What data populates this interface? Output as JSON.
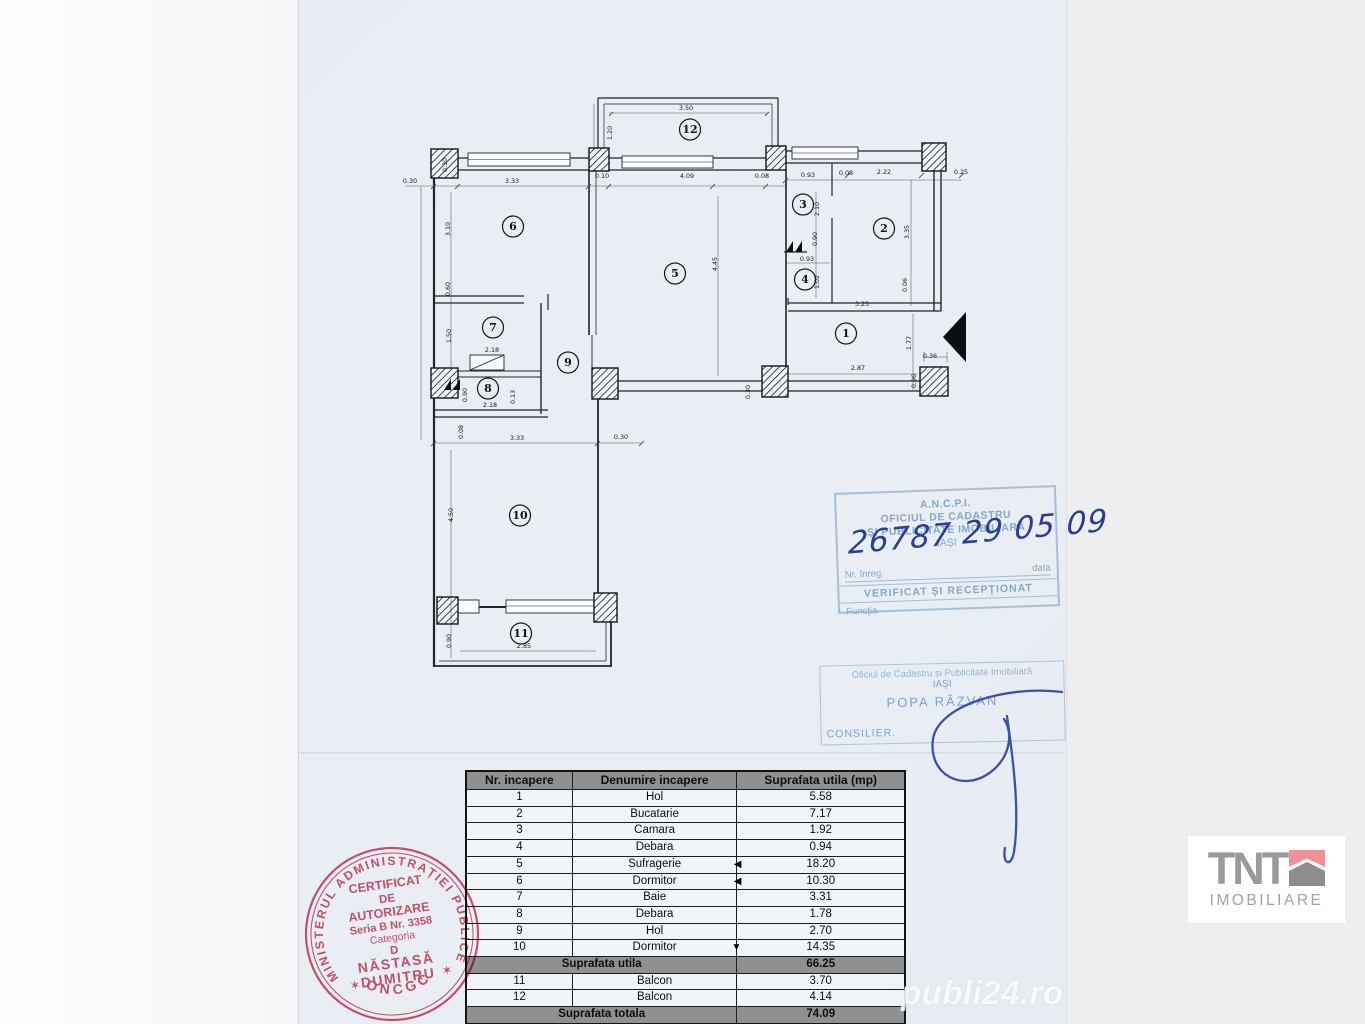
{
  "watermark": "publi24.ro",
  "logo": {
    "title": "TNT",
    "subtitle": "IMOBILIARE",
    "accent_pink": "#ef9097",
    "gray": "#9a9a9a"
  },
  "floorplan": {
    "rooms": [
      {
        "n": "1",
        "x": 846,
        "y": 337
      },
      {
        "n": "2",
        "x": 884,
        "y": 232
      },
      {
        "n": "3",
        "x": 803,
        "y": 208
      },
      {
        "n": "4",
        "x": 805,
        "y": 283
      },
      {
        "n": "5",
        "x": 675,
        "y": 277
      },
      {
        "n": "6",
        "x": 513,
        "y": 230
      },
      {
        "n": "7",
        "x": 493,
        "y": 331
      },
      {
        "n": "8",
        "x": 488,
        "y": 392
      },
      {
        "n": "9",
        "x": 568,
        "y": 366
      },
      {
        "n": "10",
        "x": 520,
        "y": 519
      },
      {
        "n": "11",
        "x": 521,
        "y": 637
      },
      {
        "n": "12",
        "x": 690,
        "y": 133
      }
    ],
    "dims": [
      {
        "t": "3.50",
        "x": 686,
        "y": 110,
        "r": 0
      },
      {
        "t": "1.20",
        "x": 612,
        "y": 133,
        "r": 1
      },
      {
        "t": "0.30",
        "x": 447,
        "y": 165,
        "r": 1
      },
      {
        "t": "0.30",
        "x": 410,
        "y": 183,
        "r": 0
      },
      {
        "t": "3.33",
        "x": 512,
        "y": 183,
        "r": 0
      },
      {
        "t": "0.10",
        "x": 602,
        "y": 178,
        "r": 0
      },
      {
        "t": "4.09",
        "x": 687,
        "y": 178,
        "r": 0
      },
      {
        "t": "0.08",
        "x": 762,
        "y": 178,
        "r": 0
      },
      {
        "t": "0.93",
        "x": 808,
        "y": 177,
        "r": 0
      },
      {
        "t": "0.08",
        "x": 846,
        "y": 175,
        "r": 0
      },
      {
        "t": "2.22",
        "x": 884,
        "y": 174,
        "r": 0
      },
      {
        "t": "0.25",
        "x": 961,
        "y": 174,
        "r": 0
      },
      {
        "t": "3.10",
        "x": 450,
        "y": 229,
        "r": 1
      },
      {
        "t": "0.60",
        "x": 450,
        "y": 289,
        "r": 1
      },
      {
        "t": "2.10",
        "x": 819,
        "y": 209,
        "r": 1
      },
      {
        "t": "0.90",
        "x": 817,
        "y": 239,
        "r": 1
      },
      {
        "t": "0.93",
        "x": 807,
        "y": 261,
        "r": 0
      },
      {
        "t": "1.02",
        "x": 819,
        "y": 282,
        "r": 1
      },
      {
        "t": "3.35",
        "x": 909,
        "y": 232,
        "r": 1
      },
      {
        "t": "0.06",
        "x": 907,
        "y": 285,
        "r": 1
      },
      {
        "t": "3.23",
        "x": 862,
        "y": 306,
        "r": 0
      },
      {
        "t": "1.77",
        "x": 911,
        "y": 343,
        "r": 1
      },
      {
        "t": "0.36",
        "x": 930,
        "y": 358,
        "r": 0
      },
      {
        "t": "0.96",
        "x": 916,
        "y": 381,
        "r": 1
      },
      {
        "t": "2.87",
        "x": 858,
        "y": 370,
        "r": 0
      },
      {
        "t": "0.30",
        "x": 750,
        "y": 392,
        "r": 1
      },
      {
        "t": "1.50",
        "x": 451,
        "y": 336,
        "r": 1
      },
      {
        "t": "2.18",
        "x": 492,
        "y": 352,
        "r": 0
      },
      {
        "t": "0.90",
        "x": 467,
        "y": 395,
        "r": 1
      },
      {
        "t": "0.13",
        "x": 515,
        "y": 397,
        "r": 1
      },
      {
        "t": "2.18",
        "x": 490,
        "y": 407,
        "r": 0
      },
      {
        "t": "0.08",
        "x": 463,
        "y": 432,
        "r": 1
      },
      {
        "t": "3.33",
        "x": 517,
        "y": 440,
        "r": 0
      },
      {
        "t": "0.30",
        "x": 621,
        "y": 439,
        "r": 0
      },
      {
        "t": "4.50",
        "x": 453,
        "y": 515,
        "r": 1
      },
      {
        "t": "0.90",
        "x": 451,
        "y": 641,
        "r": 1
      },
      {
        "t": "2.85",
        "x": 524,
        "y": 648,
        "r": 0
      },
      {
        "t": "4.45",
        "x": 717,
        "y": 264,
        "r": 1
      }
    ]
  },
  "table": {
    "headers": [
      "Nr. incapere",
      "Denumire incapere",
      "Suprafata utila (mp)"
    ],
    "rows": [
      {
        "nr": "1",
        "name": "Hol",
        "area": "5.58",
        "marker": ""
      },
      {
        "nr": "2",
        "name": "Bucatarie",
        "area": "7.17",
        "marker": ""
      },
      {
        "nr": "3",
        "name": "Camara",
        "area": "1.92",
        "marker": ""
      },
      {
        "nr": "4",
        "name": "Debara",
        "area": "0.94",
        "marker": ""
      },
      {
        "nr": "5",
        "name": "Sufragerie",
        "area": "18.20",
        "marker": "◀"
      },
      {
        "nr": "6",
        "name": "Dormitor",
        "area": "10.30",
        "marker": "◀"
      },
      {
        "nr": "7",
        "name": "Baie",
        "area": "3.31",
        "marker": ""
      },
      {
        "nr": "8",
        "name": "Debara",
        "area": "1.78",
        "marker": ""
      },
      {
        "nr": "9",
        "name": "Hol",
        "area": "2.70",
        "marker": ""
      },
      {
        "nr": "10",
        "name": "Dormitor",
        "area": "14.35",
        "marker": "▼"
      }
    ],
    "subtotal": {
      "label": "Suprafata utila",
      "value": "66.25"
    },
    "rows2": [
      {
        "nr": "11",
        "name": "Balcon",
        "area": "3.70",
        "marker": ""
      },
      {
        "nr": "12",
        "name": "Balcon",
        "area": "4.14",
        "marker": ""
      }
    ],
    "total": {
      "label": "Suprafata totala",
      "value": "74.09"
    }
  },
  "stamps": {
    "ancpi": {
      "l1": "A.N.C.P.I.",
      "l2": "OFICIUL DE CADASTRU",
      "l3": "ȘI PUBLICITATE IMOBILIARĂ",
      "l4": "IAȘI",
      "reg_label": "Nr. înreg.",
      "date_label": "data",
      "reg_no": "26787",
      "date_value": "29 05 09",
      "verified": "VERIFICAT ȘI RECEPȚIONAT",
      "function_label": "Funcția"
    },
    "blue": {
      "org": "Oficiul de Cadastru și Publicitate Imobiliară",
      "city": "IAȘI",
      "name": "POPA RĂZVAN",
      "role": "CONSILIER."
    },
    "red": {
      "ring": "MINISTERUL ADMINISTRAȚIEI PUBLICE",
      "bottom": "ONCGC",
      "star": "✶",
      "lines": [
        "CERTIFICAT",
        "DE",
        "AUTORIZARE",
        "Seria B Nr. 3358",
        "Categoria",
        "D",
        "NĂSTASĂ",
        "DUMITRU"
      ]
    }
  }
}
